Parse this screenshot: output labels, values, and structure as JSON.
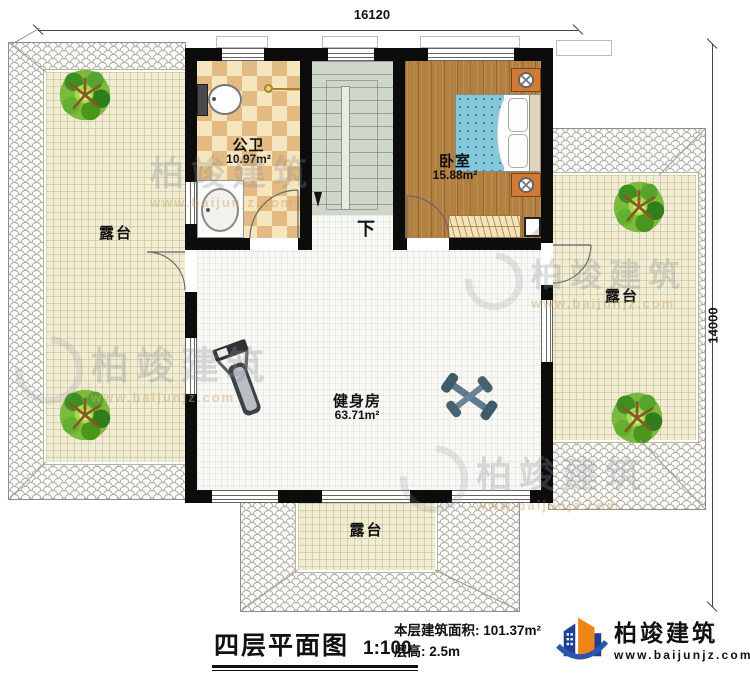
{
  "dimensions": {
    "top": "16120",
    "right": "14000"
  },
  "rooms": {
    "bathroom": {
      "name": "公卫",
      "area": "10.97m²"
    },
    "bedroom": {
      "name": "卧室",
      "area": "15.88m²"
    },
    "gym": {
      "name": "健身房",
      "area": "63.71m²"
    },
    "stairs_down_label": "下"
  },
  "terraces": {
    "left": "露台",
    "right": "露台",
    "bottom": "露台"
  },
  "title_block": {
    "title": "四层平面图",
    "scale": "1:100",
    "floor_area_label": "本层建筑面积:",
    "floor_area_value": "101.37m²",
    "floor_height_label": "层高:",
    "floor_height_value": "2.5m"
  },
  "branding": {
    "company": "柏竣建筑",
    "website": "www.baijunjz.com"
  },
  "watermark": {
    "text": "柏竣建筑",
    "url": "www.baijunjz.com"
  },
  "colors": {
    "wall": "#0c0c0c",
    "wood_floor": "#b28040",
    "bath_tile": "#e3bb82",
    "terrace": "#f0edd3",
    "stairs": "#cfd6ca",
    "bed": "#84c7da",
    "nightstand": "#d07a36",
    "tree": "#54a32a",
    "logo_blue": "#1e3f92",
    "logo_orange": "#ef8418"
  }
}
